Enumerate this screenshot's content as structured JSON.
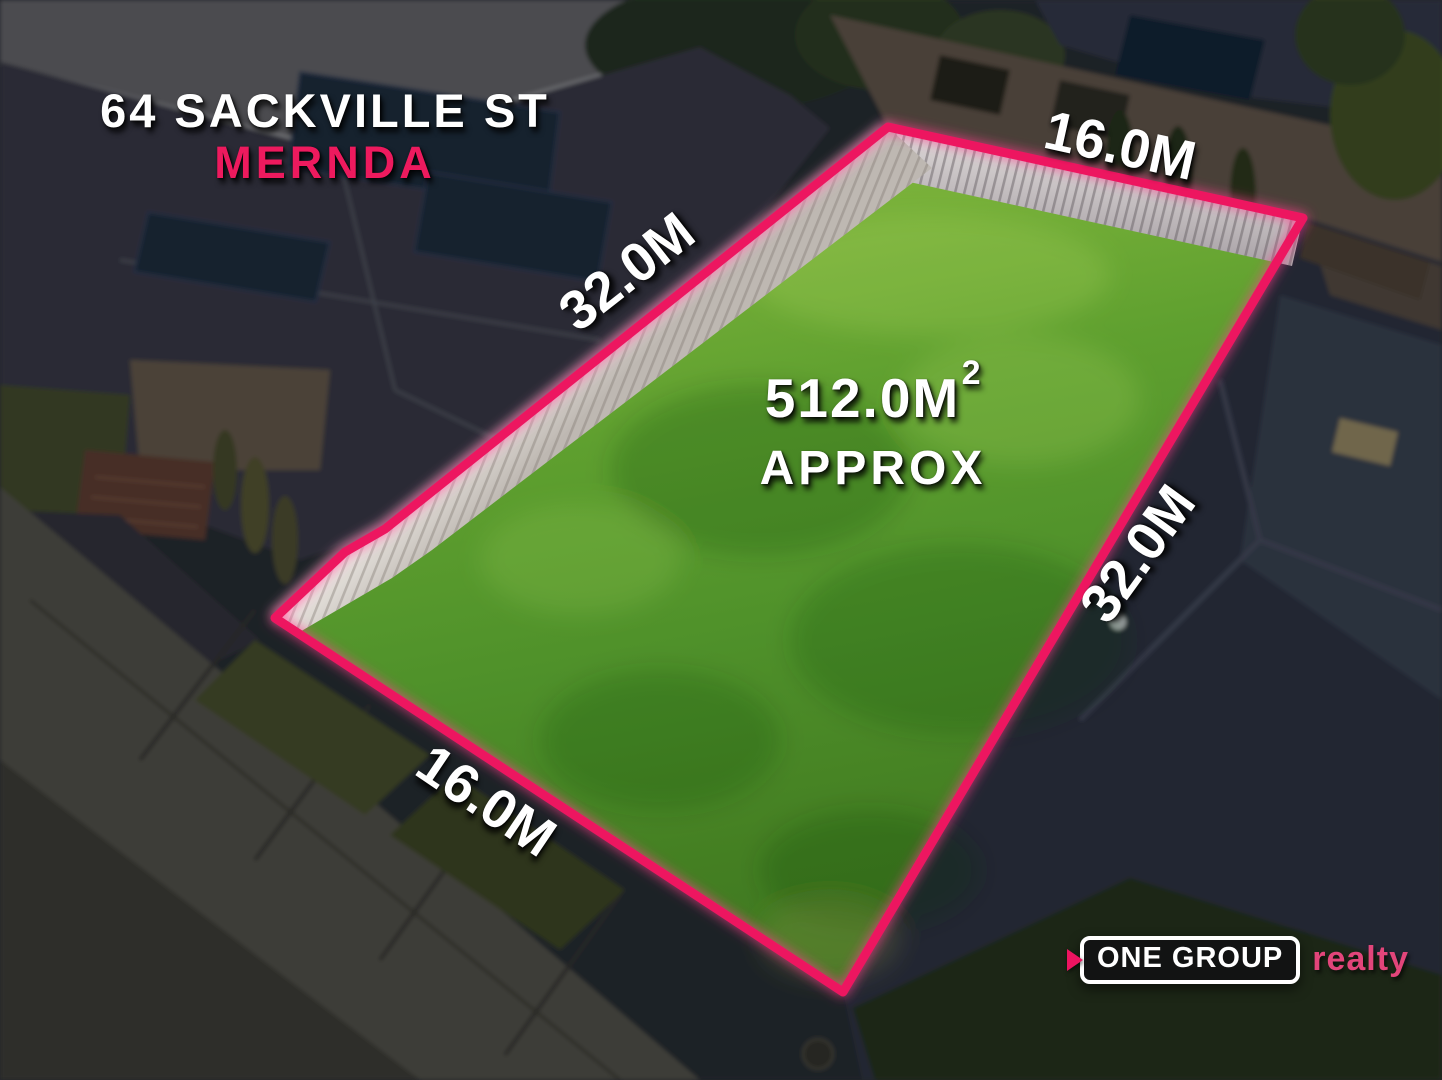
{
  "page": {
    "kind": "real-estate aerial land listing graphic"
  },
  "property": {
    "address_line1": "64 SACKVILLE ST",
    "suburb": "MERNDA",
    "area": {
      "main": "512.0M",
      "sup": "2",
      "qualifier": "APPROX"
    },
    "boundaries": {
      "top": "16.0M",
      "left": "32.0M",
      "right": "32.0M",
      "bottom": "16.0M"
    }
  },
  "branding": {
    "agency_name": "ONE GROUP",
    "agency_suffix": "realty"
  },
  "colors": {
    "accent_pink": "#ED1460",
    "suburb_pink": "#ED1A5E",
    "realty_pink": "#E2457A",
    "lot_green": "#55962A",
    "fence_white": "#EDEAE4",
    "label_white": "#FFFFFF",
    "background_dark": "#23252B"
  }
}
